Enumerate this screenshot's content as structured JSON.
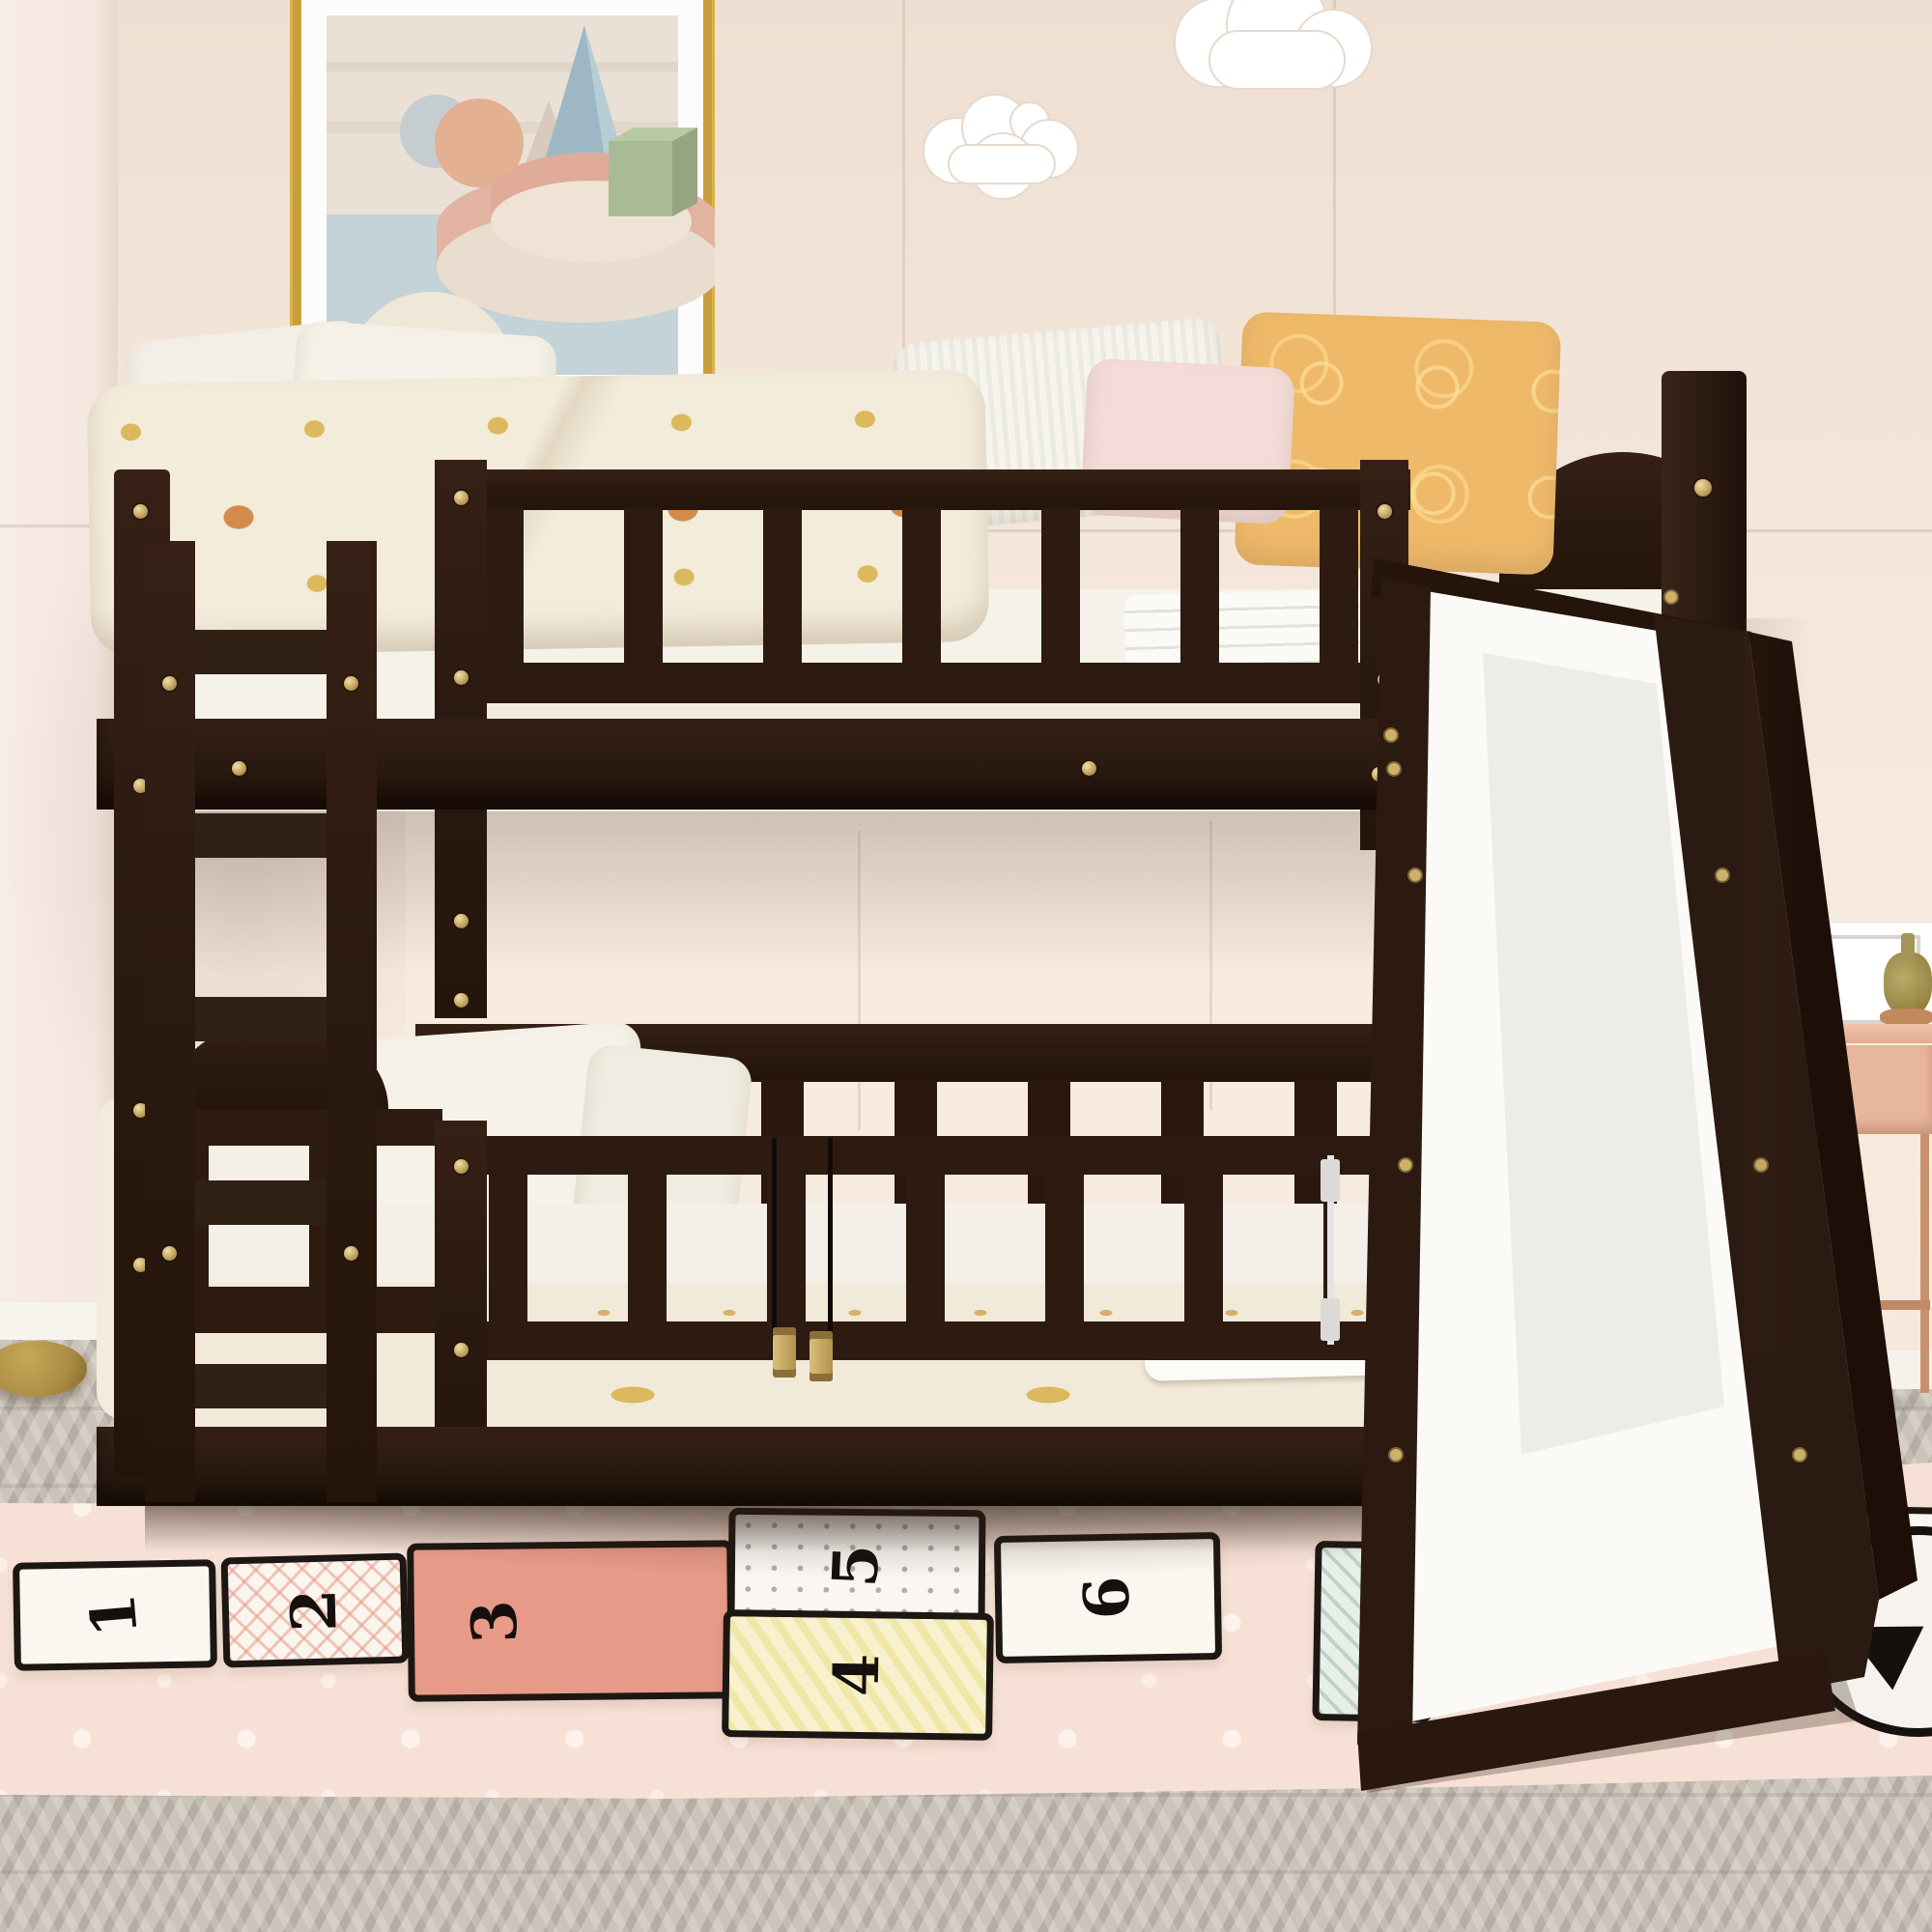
{
  "scene": {
    "type": "lifestyle product photo",
    "subject": "Espresso twin-over-twin low bunk bed with ladder, safety guardrail gates and slide",
    "room": "kids bedroom"
  },
  "palette": {
    "wall": "#f2e5da",
    "wall_upper": "#efdfd2",
    "wall_left": "#f6eae3",
    "baseboard": "#f7f3ed",
    "floor_base": "#ccc4bb",
    "floor_stripe": "#bdb4aa",
    "rug_pink": "#f7e1d6",
    "rug_dot": "#fdf3ec",
    "wood_espresso": "#2c1a11",
    "hardware_gold": "#c9ab62",
    "hinge_silver": "#e6e4e0",
    "mattress_white": "#f5f2ea",
    "sheet_cream": "#f2ebd9",
    "sheet_dot_orange": "#cd7a2f",
    "sheet_dot_gold": "#d2a93e",
    "pillow_white": "#f6f3eb",
    "pillow_pink": "#f4dcd8",
    "pillow_orange": "#efb96a",
    "slide_white": "#fbfaf7",
    "nightstand_pink": "#e9b79e",
    "nightstand_wood": "#b5856a",
    "leg_copper": "#c8906e",
    "bottle_amber": "#8f7d36",
    "lamp_gold": "#ab8c44",
    "frame_gold": "#d9b44a",
    "cloud_white": "#ffffff"
  },
  "artwork": {
    "style": "pastel geometric abstract print in gold frame with white mat",
    "shapes": [
      "peach sphere",
      "gray circle",
      "blue pyramid",
      "sage green cube",
      "pink stacked discs",
      "cream half dome"
    ]
  },
  "wall_decor": {
    "clouds": [
      "small white cloud",
      "large white cloud"
    ]
  },
  "bed": {
    "material": "espresso solid wood with gold screws",
    "top_bunk": {
      "guardrail_slats": 7,
      "bedding": "cream knit blanket with orange and gold dots",
      "pillows": [
        "white",
        "white",
        "white",
        "blush pink",
        "orange patterned"
      ]
    },
    "bottom_bunk": {
      "gate": "double swing safety gate with brass center hinges and silver side hinge",
      "bedding": "cream polka dot sheet with white folded blanket",
      "pillows": [
        "white",
        "white"
      ]
    },
    "ladder": {
      "position": "left",
      "rungs": 5
    },
    "slide": {
      "position": "right",
      "surface": "white",
      "rails": "espresso"
    }
  },
  "rug": {
    "style": "pink hopscotch play mat with white polka dots and black outlined squares",
    "squares": [
      {
        "number": "1",
        "fill": "white"
      },
      {
        "number": "2",
        "fill": "white with pink triangle grid"
      },
      {
        "number": "3",
        "fill": "salmon"
      },
      {
        "number": "4",
        "fill": "pale yellow diagonal stripes"
      },
      {
        "number": "5",
        "fill": "white with gray dots"
      },
      {
        "number": "6",
        "fill": "white"
      },
      {
        "number": "8",
        "fill": "white"
      }
    ],
    "decoration": {
      "glyph": "▲",
      "description": "white circle with black marker drawing"
    }
  },
  "nightstand": {
    "color": "blush pink with wood panel and copper legs",
    "items": [
      "white picture frame",
      "amber glass bottle"
    ]
  },
  "floor": {
    "type": "gray herringbone wood"
  },
  "lamp": {
    "part": "round brass floor-lamp base"
  }
}
